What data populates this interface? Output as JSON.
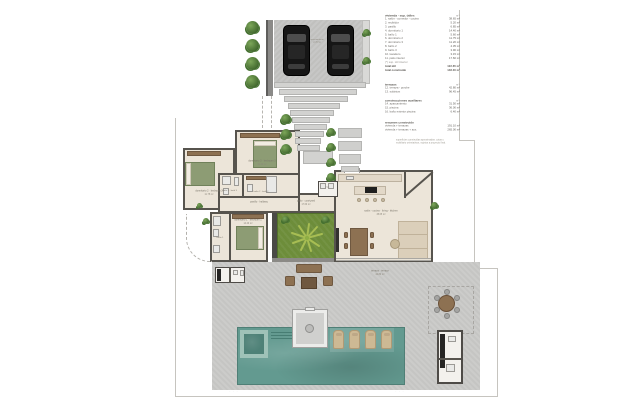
{
  "legend": {
    "sections": [
      {
        "title": "vivienda · sup. útiles",
        "unit": "m²",
        "rows": [
          {
            "label": "1. salón - comedor - cocina",
            "value": "38.65 m²"
          },
          {
            "label": "2. recibidor",
            "value": "5.20 m²"
          },
          {
            "label": "3. pasillo",
            "value": "6.85 m²"
          },
          {
            "label": "4. dormitorio 1",
            "value": "14.40 m²"
          },
          {
            "label": "5. baño 1",
            "value": "5.60 m²"
          },
          {
            "label": "6. dormitorio 2",
            "value": "11.75 m²"
          },
          {
            "label": "7. dormitorio 3",
            "value": "11.20 m²"
          },
          {
            "label": "8. baño 2",
            "value": "4.35 m²"
          },
          {
            "label": "9. baño 3",
            "value": "3.90 m²"
          },
          {
            "label": "10. lavadero",
            "value": "3.15 m²"
          },
          {
            "label": "11. patio interior",
            "value": "17.60 m²"
          },
          {
            "label": "(*) sup. útil interior",
            "value": "",
            "muted": true
          },
          {
            "label": "total útil",
            "value": "122.65 m²",
            "strong": true
          },
          {
            "label": "total construido",
            "value": "148.30 m²",
            "strong": true
          }
        ]
      },
      {
        "title": "terrazas",
        "unit": "m²",
        "rows": [
          {
            "label": "12. terraza - porche",
            "value": "42.80 m²"
          },
          {
            "label": "13. solárium",
            "value": "96.45 m²"
          }
        ]
      },
      {
        "title": "construcciones auxiliares",
        "unit": "m²",
        "rows": [
          {
            "label": "14. aparcamiento",
            "value": "31.50 m²"
          },
          {
            "label": "15. piscina",
            "value": "36.00 m²"
          },
          {
            "label": "16. baño exterior piscina",
            "value": "6.40 m²"
          }
        ]
      },
      {
        "title": "resumen construido",
        "unit": "",
        "rows": [
          {
            "label": "vivienda + terrazas",
            "value": "191.10 m²"
          },
          {
            "label": "vivienda + terrazas + aux.",
            "value": "265.00 m²"
          }
        ]
      }
    ]
  },
  "note": {
    "line1": "superficies construidas aproximadas. cotas y",
    "line2": "mobiliario orientativos, sujetos a proyecto final."
  },
  "plan": {
    "labels": {
      "bedroom2": {
        "name": "dormitorio 2 · bedroom 2",
        "area": "11.75 m²"
      },
      "bedroom3": {
        "name": "dormitorio 3 · bedroom 3",
        "area": "11.20 m²"
      },
      "bath3": {
        "name": "baño 3 · bath 3",
        "area": ""
      },
      "bath2": {
        "name": "baño 2 · bath 2",
        "area": ""
      },
      "bath1": {
        "name": "baño 1",
        "area": ""
      },
      "master": {
        "name": "dormitorio 1 · bedroom 1",
        "area": "14.40 m²"
      },
      "hallway": {
        "name": "pasillo · hallway",
        "area": ""
      },
      "patio": {
        "name": "patio · courtyard",
        "area": "17.60 m²"
      },
      "living": {
        "name": "salón - cocina · living - kitchen",
        "area": "38.65 m²"
      },
      "laundry": {
        "name": "lav.",
        "area": ""
      },
      "terrace": {
        "name": "terraza · terrace",
        "area": "42.80 m²"
      },
      "parking": {
        "name": "aparcamiento",
        "area": "parking"
      }
    },
    "marks_left": "· · ·",
    "marks_right": "· · ·"
  },
  "colors": {
    "grass": "#6d8d3a",
    "pool": "#639a90",
    "concrete": "#c9c9c7",
    "wall": "#57544e",
    "wood": "#8d7152",
    "bed_green": "#8d9c74"
  }
}
